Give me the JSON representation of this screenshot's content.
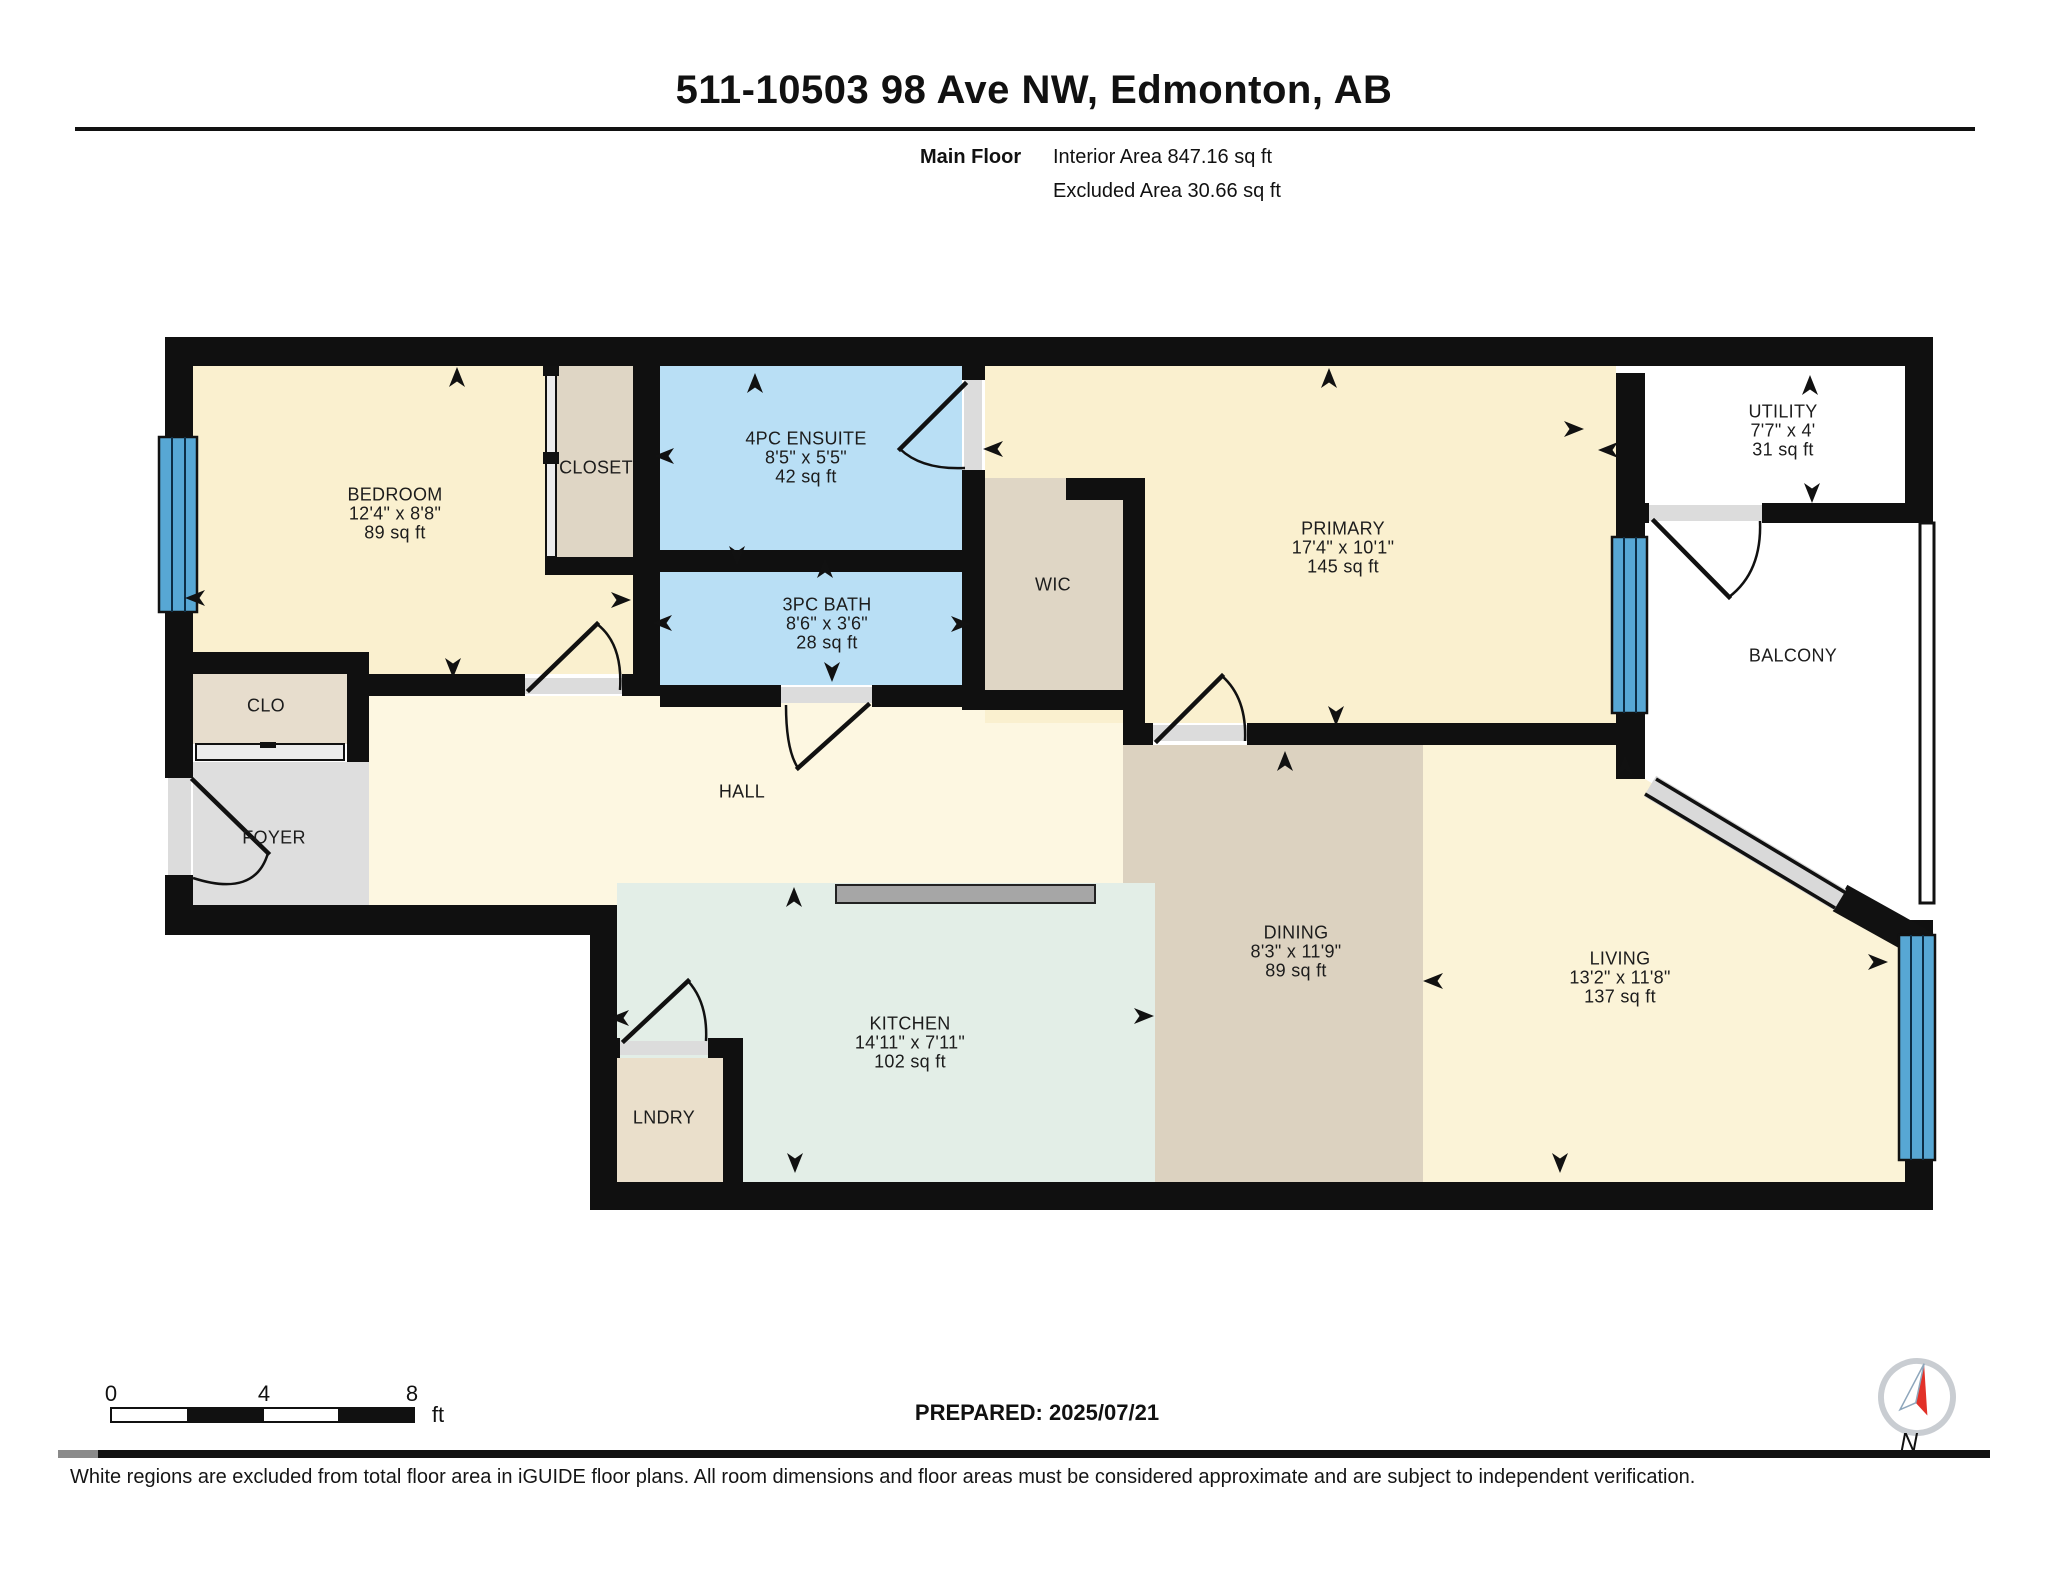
{
  "header": {
    "title": "511-10503 98 Ave NW, Edmonton, AB",
    "floor_label": "Main Floor",
    "interior_area": "Interior Area 847.16 sq ft",
    "excluded_area": "Excluded Area 30.66 sq ft"
  },
  "rooms": {
    "bedroom": {
      "name": "BEDROOM",
      "dims": "12'4\" x 8'8\"",
      "area": "89 sq ft"
    },
    "closet": {
      "name": "CLOSET"
    },
    "ensuite": {
      "name": "4PC ENSUITE",
      "dims": "8'5\" x 5'5\"",
      "area": "42 sq ft"
    },
    "bath": {
      "name": "3PC BATH",
      "dims": "8'6\" x 3'6\"",
      "area": "28 sq ft"
    },
    "wic": {
      "name": "WIC"
    },
    "primary": {
      "name": "PRIMARY",
      "dims": "17'4\" x 10'1\"",
      "area": "145 sq ft"
    },
    "utility": {
      "name": "UTILITY",
      "dims": "7'7\" x 4'",
      "area": "31 sq ft"
    },
    "balcony": {
      "name": "BALCONY"
    },
    "clo": {
      "name": "CLO"
    },
    "foyer": {
      "name": "FOYER"
    },
    "hall": {
      "name": "HALL"
    },
    "kitchen": {
      "name": "KITCHEN",
      "dims": "14'11\" x 7'11\"",
      "area": "102 sq ft"
    },
    "lndry": {
      "name": "LNDRY"
    },
    "dining": {
      "name": "DINING",
      "dims": "8'3\" x 11'9\"",
      "area": "89 sq ft"
    },
    "living": {
      "name": "LIVING",
      "dims": "13'2\" x 11'8\"",
      "area": "137 sq ft"
    }
  },
  "scale_bar": {
    "ticks": [
      "0",
      "4",
      "8"
    ],
    "unit": "ft"
  },
  "prepared_label": "PREPARED: 2025/07/21",
  "compass_label": "N",
  "footer_disclaimer": "White regions are excluded from total floor area in iGUIDE floor plans. All room dimensions and floor areas must be considered approximate and are subject to independent verification.",
  "colors": {
    "wall": "#101010",
    "warm": "#faf0cf",
    "hall": "#fdf7e1",
    "living": "#fbf3d7",
    "kitchen": "#e3eee7",
    "bath": "#b9dff5",
    "tan": "#dfd6c5",
    "dining": "#dcd2c0",
    "clo": "#e7ddcd",
    "lndry": "#eadfcb",
    "foyer": "#dedede",
    "window": "#57a7d4",
    "threshold": "#dcdcdc",
    "island": "#a6a6a6"
  }
}
